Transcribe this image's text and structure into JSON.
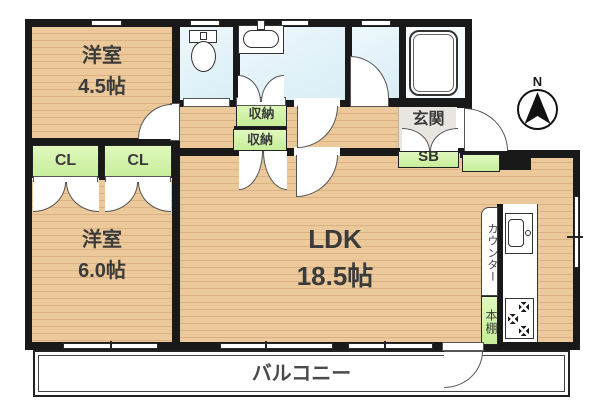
{
  "colors": {
    "wall": "#191919",
    "wood": "#ebc99b",
    "wood_line": "#dcb184",
    "water": "#d9edf6",
    "green": "#c6ee9a",
    "green_hi": "#e0f8bd",
    "genkan": "#e9e5e0"
  },
  "compass": {
    "north_label": "N"
  },
  "rooms": {
    "bedroom1": {
      "name": "洋室",
      "size": "4.5帖"
    },
    "bedroom2": {
      "name": "洋室",
      "size": "6.0帖"
    },
    "ldk": {
      "name": "LDK",
      "size": "18.5帖"
    },
    "balcony": {
      "label": "バルコニー"
    },
    "entrance": {
      "label": "玄関"
    },
    "shoe_box": {
      "label": "SB"
    },
    "closet_left": {
      "label": "CL"
    },
    "closet_right": {
      "label": "CL"
    },
    "storage_upper": {
      "label": "収納"
    },
    "storage_lower": {
      "label": "収納"
    },
    "counter": {
      "label": "カウンター"
    },
    "bookshelf": {
      "label": "本棚"
    }
  }
}
